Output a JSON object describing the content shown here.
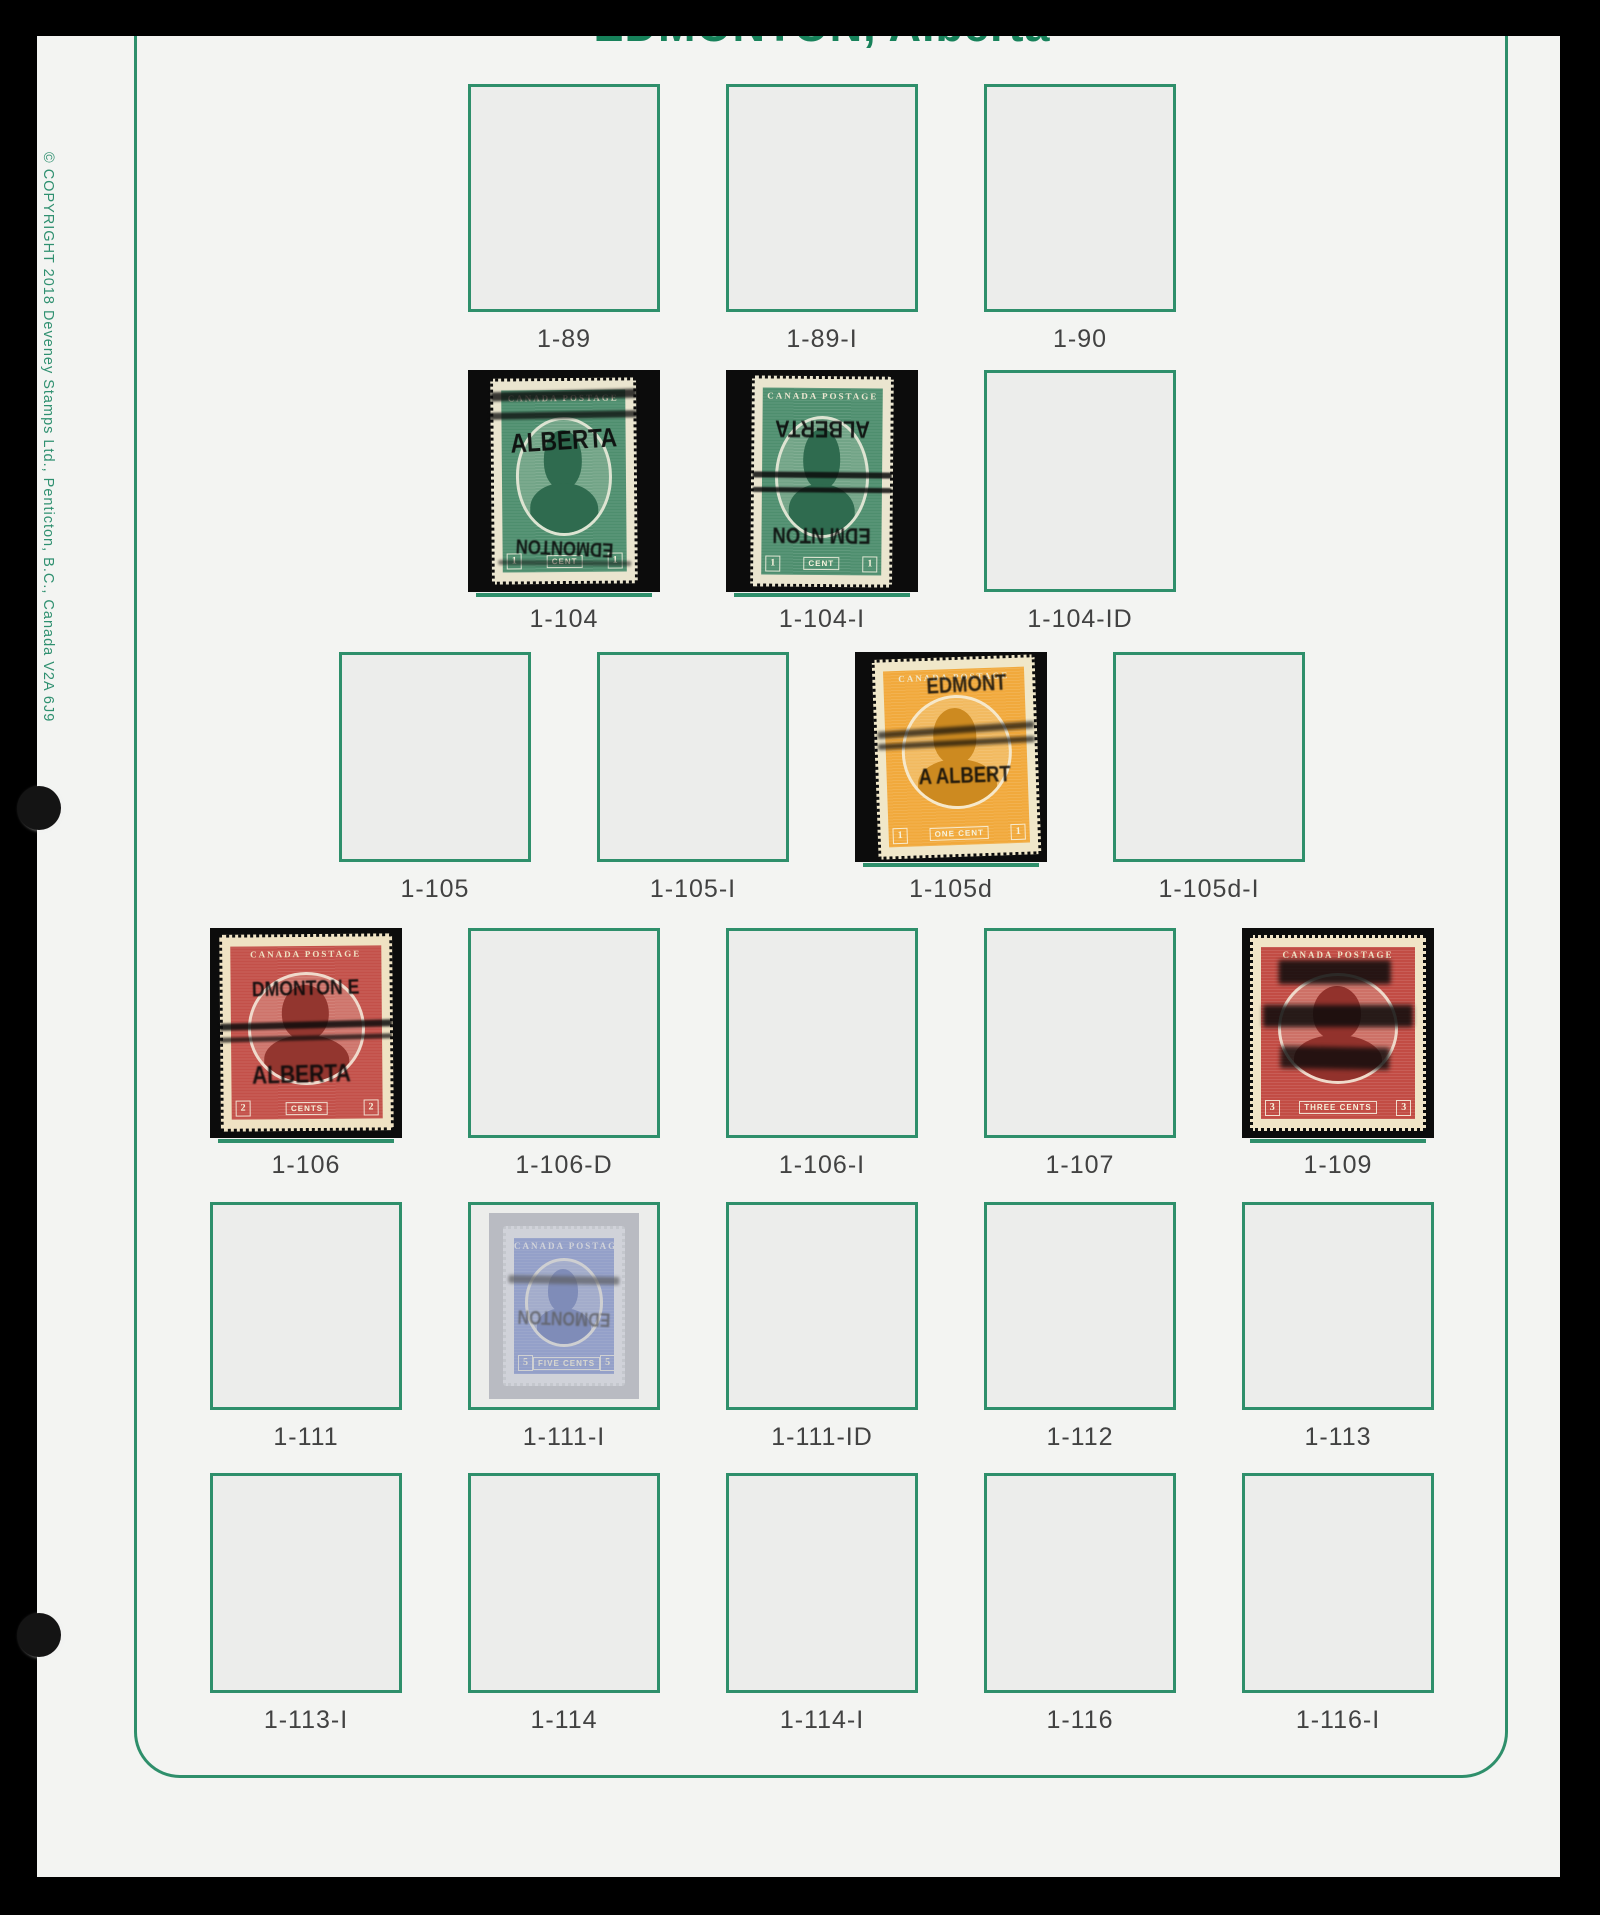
{
  "page": {
    "title": "EDMONTON, Alberta",
    "copyright": "© COPYRIGHT 2018  Deveney Stamps Ltd., Penticton, B.C., Canada V2A 6J9",
    "colors": {
      "frame_green": "#2e8f6b",
      "title_green": "#17815a",
      "page_bg": "#f3f4f2",
      "box_bg": "#ecedeb",
      "mount_black": "#0c0c0c",
      "label_color": "#424242"
    }
  },
  "stamp_styles": {
    "green1c": {
      "ink": "#4e8e6e",
      "dark": "#2f6b4f",
      "paper": "#eae5cf",
      "top_text": "CANADA POSTAGE",
      "denom": [
        "1",
        "CENT",
        "1"
      ]
    },
    "orange1c": {
      "ink": "#f1a93c",
      "dark": "#cd8a20",
      "paper": "#f0e7c9",
      "top_text": "CANADA POSTAGE",
      "denom": [
        "1",
        "ONE CENT",
        "1"
      ]
    },
    "red2c": {
      "ink": "#c35049",
      "dark": "#93362f",
      "paper": "#efe2c3",
      "top_text": "CANADA POSTAGE",
      "denom": [
        "2",
        "CENTS",
        "2"
      ]
    },
    "red3c": {
      "ink": "#c24c44",
      "dark": "#92322c",
      "paper": "#f0e4c7",
      "top_text": "CANADA POSTAGE",
      "denom": [
        "3",
        "THREE CENTS",
        "3"
      ]
    },
    "blue5c": {
      "ink": "#7488cd",
      "dark": "#4d62ab",
      "paper": "#e5e7ef",
      "top_text": "CANADA POSTAGE",
      "denom": [
        "5",
        "FIVE CENTS",
        "5"
      ]
    }
  },
  "overprints": {
    "1-104": [
      {
        "t": "bar",
        "x": 50,
        "y": 7,
        "w": 104,
        "h": 9,
        "rot": -1,
        "blur": 1.2,
        "op": 0.8
      },
      {
        "t": "bar",
        "x": 50,
        "y": 17,
        "w": 106,
        "h": 7,
        "rot": -0.5,
        "blur": 1.0,
        "op": 0.75
      },
      {
        "t": "text",
        "v": "ALBERTA",
        "x": 50,
        "y": 30,
        "fs": 27,
        "rot": -3,
        "blur": 0.3,
        "op": 0.92
      },
      {
        "t": "text",
        "v": "EDMONTON",
        "x": 50,
        "y": 83,
        "fs": 20,
        "rot": 183,
        "blur": 0.6,
        "op": 0.9
      },
      {
        "t": "bar",
        "x": 50,
        "y": 91,
        "w": 95,
        "h": 5,
        "rot": 1,
        "blur": 1.2,
        "op": 0.5
      }
    ],
    "1-104-I": [
      {
        "t": "text",
        "v": "ALBERTA",
        "x": 50,
        "y": 24,
        "fs": 24,
        "rot": 180,
        "blur": 0.4,
        "op": 0.9
      },
      {
        "t": "bar",
        "x": 50,
        "y": 47,
        "w": 102,
        "h": 6,
        "rot": 0,
        "blur": 0.8,
        "op": 0.85
      },
      {
        "t": "bar",
        "x": 50,
        "y": 54,
        "w": 102,
        "h": 5,
        "rot": 0,
        "blur": 0.8,
        "op": 0.85
      },
      {
        "t": "text",
        "v": "EDM NTON",
        "x": 50,
        "y": 76,
        "fs": 22,
        "rot": 180,
        "blur": 0.5,
        "op": 0.9
      }
    ],
    "1-105d": [
      {
        "t": "text",
        "v": "EDMONT",
        "x": 58,
        "y": 13,
        "fs": 22,
        "rot": -1,
        "blur": 0.6,
        "op": 0.85
      },
      {
        "t": "bar",
        "x": 50,
        "y": 36,
        "w": 100,
        "h": 7,
        "rot": -2,
        "blur": 1.5,
        "op": 0.7
      },
      {
        "t": "bar",
        "x": 50,
        "y": 43,
        "w": 100,
        "h": 6,
        "rot": -1,
        "blur": 1.5,
        "op": 0.7
      },
      {
        "t": "text",
        "v": "A   ALBERT",
        "x": 55,
        "y": 60,
        "fs": 22,
        "rot": 0,
        "blur": 0.5,
        "op": 0.88
      }
    ],
    "1-106": [
      {
        "t": "text",
        "v": "DMONTON E",
        "x": 50,
        "y": 27,
        "fs": 21,
        "rot": -1,
        "blur": 0.5,
        "op": 0.9
      },
      {
        "t": "bar",
        "x": 50,
        "y": 46,
        "w": 104,
        "h": 7,
        "rot": -1,
        "blur": 1.0,
        "op": 0.85
      },
      {
        "t": "bar",
        "x": 50,
        "y": 53,
        "w": 104,
        "h": 5,
        "rot": -1,
        "blur": 1.0,
        "op": 0.7
      },
      {
        "t": "text",
        "v": "ALBERTA",
        "x": 47,
        "y": 72,
        "fs": 25,
        "rot": -1,
        "blur": 0.8,
        "op": 0.92
      }
    ],
    "1-109": [
      {
        "t": "bar",
        "x": 48,
        "y": 18,
        "w": 66,
        "h": 24,
        "rot": 0,
        "blur": 2.5,
        "op": 0.85
      },
      {
        "t": "bar",
        "x": 50,
        "y": 41,
        "w": 88,
        "h": 22,
        "rot": 0,
        "blur": 2.5,
        "op": 0.85
      },
      {
        "t": "bar",
        "x": 48,
        "y": 63,
        "w": 64,
        "h": 22,
        "rot": 1,
        "blur": 2.5,
        "op": 0.8
      }
    ],
    "1-111-I": [
      {
        "t": "bar",
        "x": 50,
        "y": 33,
        "w": 96,
        "h": 8,
        "rot": 1,
        "blur": 1.5,
        "op": 0.7
      },
      {
        "t": "text",
        "v": "EDMONTON",
        "x": 50,
        "y": 57,
        "fs": 19,
        "rot": 182,
        "blur": 0.8,
        "op": 0.8
      }
    ]
  },
  "rows": [
    {
      "name": "row-1",
      "top": 84,
      "box_h": 228,
      "cells": [
        {
          "label": "1-89",
          "type": "empty"
        },
        {
          "label": "1-89-I",
          "type": "empty"
        },
        {
          "label": "1-90",
          "type": "empty"
        }
      ]
    },
    {
      "name": "row-2",
      "top": 370,
      "box_h": 222,
      "cells": [
        {
          "label": "1-104",
          "type": "mounted",
          "stamp": {
            "style": "green1c",
            "tilt": -0.5,
            "w": 76,
            "h": 93
          }
        },
        {
          "label": "1-104-I",
          "type": "mounted",
          "stamp": {
            "style": "green1c",
            "tilt": 0.5,
            "w": 74,
            "h": 95
          }
        },
        {
          "label": "1-104-ID",
          "type": "empty"
        }
      ]
    },
    {
      "name": "row-3",
      "top": 652,
      "box_h": 210,
      "cells": [
        {
          "label": "1-105",
          "type": "empty"
        },
        {
          "label": "1-105-I",
          "type": "empty"
        },
        {
          "label": "1-105d",
          "type": "mounted",
          "stamp": {
            "style": "orange1c",
            "tilt": -2,
            "w": 85,
            "h": 95,
            "dx": 6
          }
        },
        {
          "label": "1-105d-I",
          "type": "empty"
        }
      ]
    },
    {
      "name": "row-4",
      "top": 928,
      "box_h": 210,
      "cells": [
        {
          "label": "1-106",
          "type": "mounted",
          "stamp": {
            "style": "red2c",
            "tilt": -0.5,
            "w": 90,
            "h": 94
          }
        },
        {
          "label": "1-106-D",
          "type": "empty"
        },
        {
          "label": "1-106-I",
          "type": "empty"
        },
        {
          "label": "1-107",
          "type": "empty"
        },
        {
          "label": "1-109",
          "type": "mounted",
          "stamp": {
            "style": "red3c",
            "tilt": 0,
            "w": 92,
            "h": 93
          }
        }
      ]
    },
    {
      "name": "row-5",
      "top": 1202,
      "box_h": 208,
      "cells": [
        {
          "label": "1-111",
          "type": "empty"
        },
        {
          "label": "1-111-I",
          "type": "boxed-faded",
          "stamp": {
            "style": "blue5c",
            "tilt": 0,
            "faded": true
          }
        },
        {
          "label": "1-111-ID",
          "type": "empty"
        },
        {
          "label": "1-112",
          "type": "empty"
        },
        {
          "label": "1-113",
          "type": "empty"
        }
      ]
    },
    {
      "name": "row-6",
      "top": 1473,
      "box_h": 220,
      "cells": [
        {
          "label": "1-113-I",
          "type": "empty"
        },
        {
          "label": "1-114",
          "type": "empty"
        },
        {
          "label": "1-114-I",
          "type": "empty"
        },
        {
          "label": "1-116",
          "type": "empty"
        },
        {
          "label": "1-116-I",
          "type": "empty"
        }
      ]
    }
  ]
}
